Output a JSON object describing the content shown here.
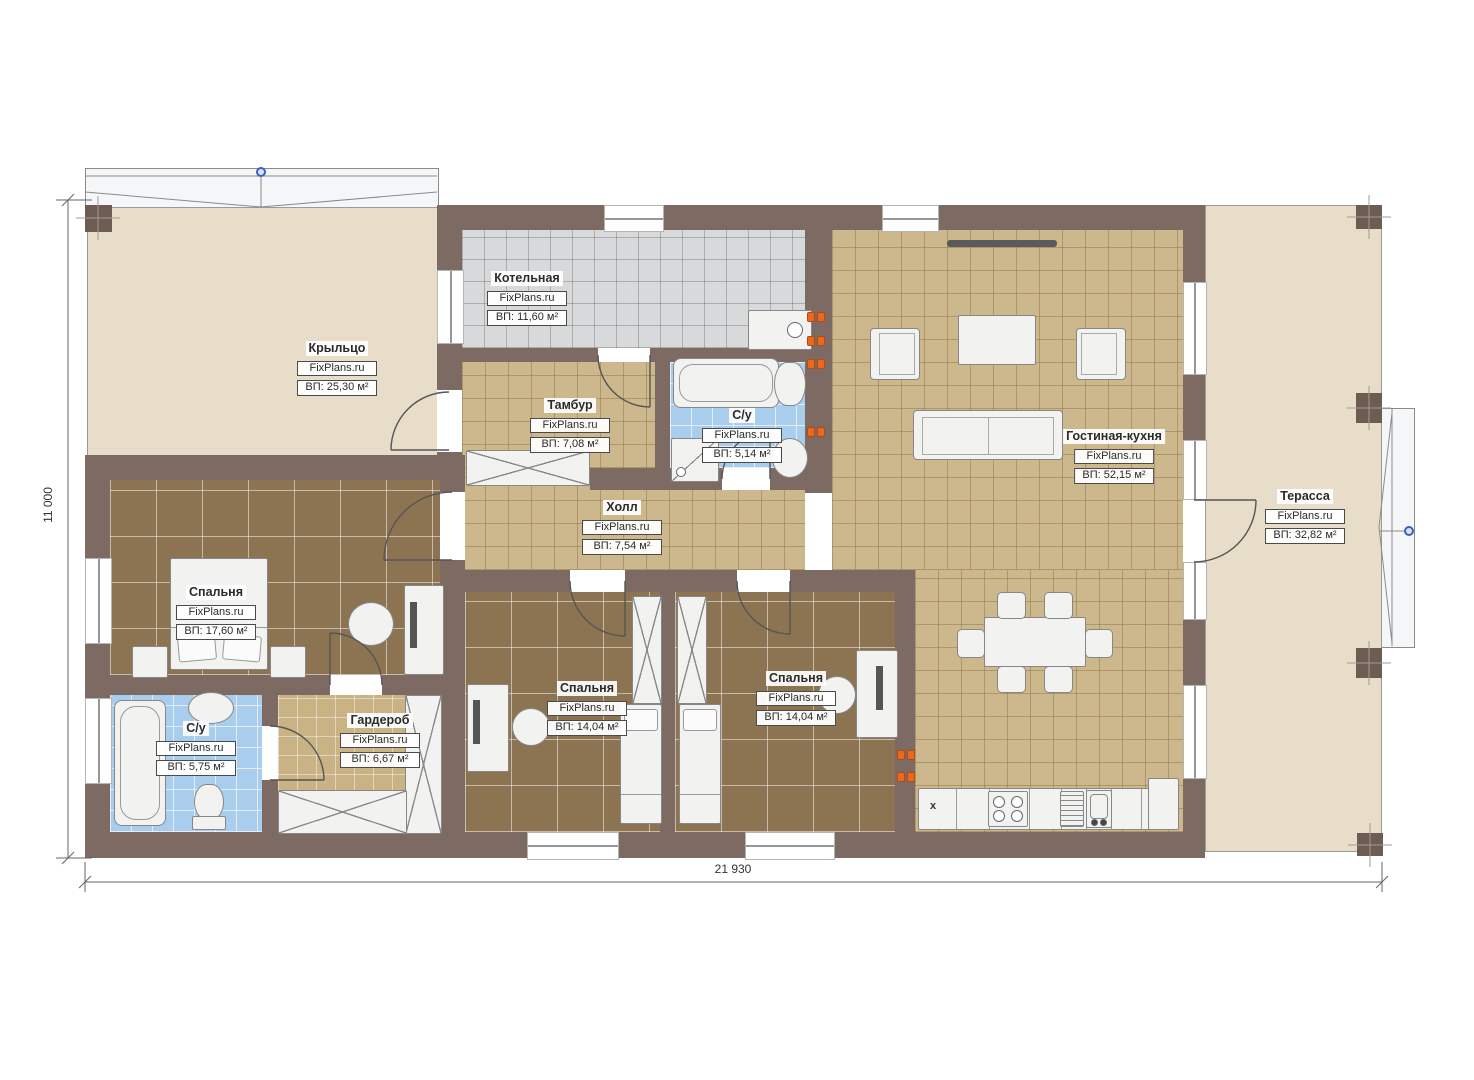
{
  "plan": {
    "dim_width": "21 930",
    "dim_height": "11 000"
  },
  "rooms": [
    {
      "name": "Крыльцо",
      "brand": "FixPlans.ru",
      "area": "ВП: 25,30 м²"
    },
    {
      "name": "Котельная",
      "brand": "FixPlans.ru",
      "area": "ВП: 11,60 м²"
    },
    {
      "name": "Тамбур",
      "brand": "FixPlans.ru",
      "area": "ВП: 7,08 м²"
    },
    {
      "name": "С/у",
      "brand": "FixPlans.ru",
      "area": "ВП: 5,14 м²"
    },
    {
      "name": "Гостиная-кухня",
      "brand": "FixPlans.ru",
      "area": "ВП: 52,15 м²"
    },
    {
      "name": "Терасса",
      "brand": "FixPlans.ru",
      "area": "ВП: 32,82 м²"
    },
    {
      "name": "Холл",
      "brand": "FixPlans.ru",
      "area": "ВП: 7,54 м²"
    },
    {
      "name": "Спальня",
      "brand": "FixPlans.ru",
      "area": "ВП: 17,60 м²"
    },
    {
      "name": "С/у",
      "brand": "FixPlans.ru",
      "area": "ВП: 5,75 м²"
    },
    {
      "name": "Гардероб",
      "brand": "FixPlans.ru",
      "area": "ВП: 6,67 м²"
    },
    {
      "name": "Спальня",
      "brand": "FixPlans.ru",
      "area": "ВП: 14,04 м²"
    },
    {
      "name": "Спальня",
      "brand": "FixPlans.ru",
      "area": "ВП: 14,04 м²"
    }
  ],
  "kitchen": {
    "x_marker": "x"
  },
  "colors": {
    "wall": "#7d6a62",
    "post": "#6e5b51",
    "floor_tan": "#cdb78c",
    "floor_dark": "#8c7452",
    "floor_blue": "#a9cdec",
    "floor_gray": "#d8d9da",
    "floor_beige": "#e8ddc9",
    "socket_orange": "#e96a1e",
    "node_blue": "#3a5fc8"
  }
}
